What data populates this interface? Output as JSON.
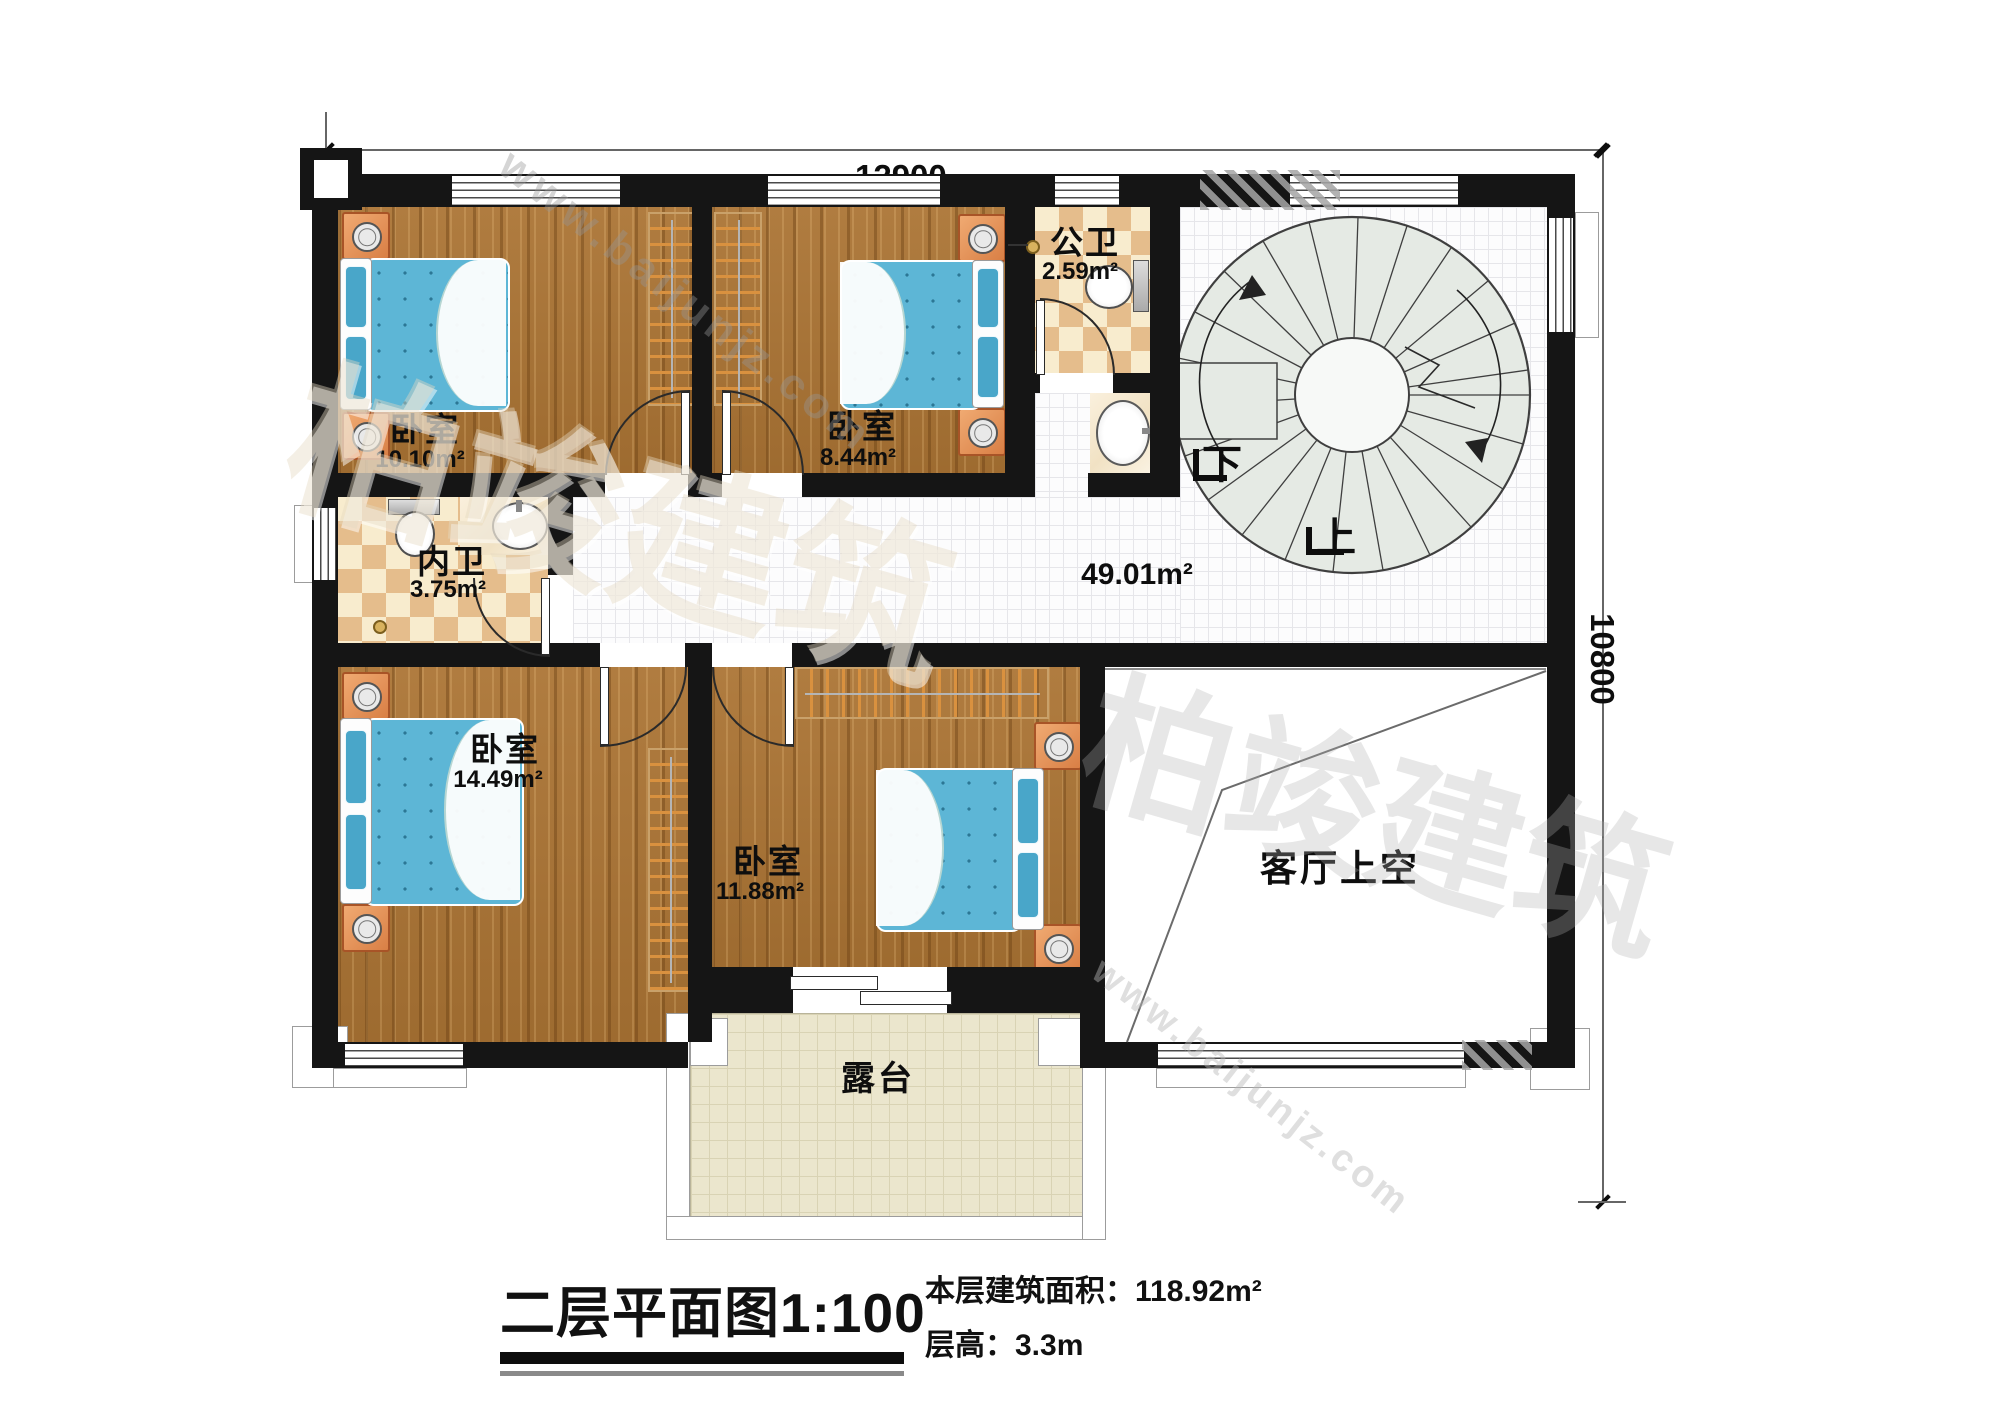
{
  "watermark": {
    "brand": "柏竣建筑",
    "url": "www.baijunjz.com"
  },
  "dimensions": {
    "width_label": "12900",
    "height_label": "10800"
  },
  "plan": {
    "rooms": {
      "bedroom_tl": {
        "name": "卧室",
        "area": "10.10m²"
      },
      "bedroom_tm": {
        "name": "卧室",
        "area": "8.44m²"
      },
      "public_bath": {
        "name": "公卫",
        "area": "2.59m²"
      },
      "inner_bath": {
        "name": "内卫",
        "area": "3.75m²"
      },
      "bedroom_bl": {
        "name": "卧室",
        "area": "14.49m²"
      },
      "bedroom_bm": {
        "name": "卧室",
        "area": "11.88m²"
      },
      "hall": {
        "area": "49.01m²"
      },
      "living_void": {
        "name": "客厅上空"
      },
      "terrace": {
        "name": "露台"
      }
    },
    "stairs": {
      "down": "下",
      "up": "上"
    }
  },
  "footer": {
    "title": "二层平面图1:100",
    "area_label": "本层建筑面积：",
    "area_value": "118.92m²",
    "height_label": "层高：",
    "height_value": "3.3m"
  }
}
